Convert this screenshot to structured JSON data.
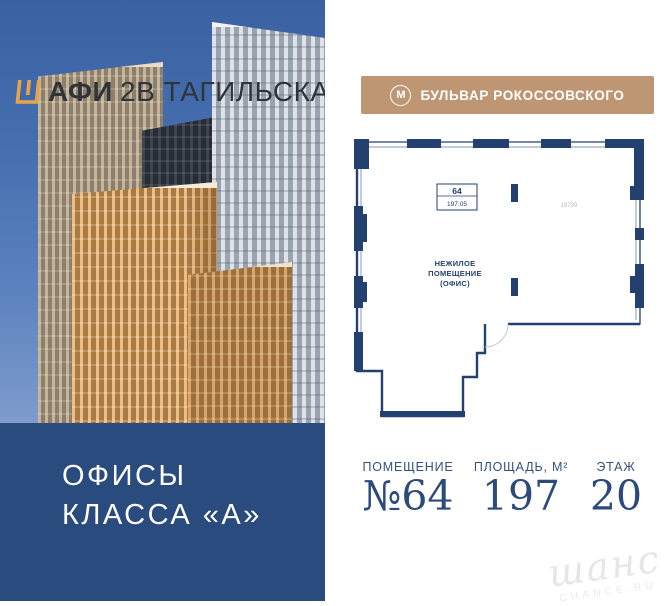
{
  "brand": {
    "logo_glyph": "afi-mark",
    "name_bold": "АФИ",
    "name_rest": "2В ТАГИЛЬСКАЯ"
  },
  "hero": {
    "offices_line1": "ОФИСЫ",
    "offices_line2": "КЛАССА «А»"
  },
  "metro": {
    "icon_letter": "М",
    "label": "БУЛЬВАР РОКОССОВСКОГО"
  },
  "plan": {
    "unit_box_number": "64",
    "unit_box_area": "197.05",
    "room_label_line1": "НЕЖИЛОЕ",
    "room_label_line2": "ПОМЕЩЕНИЕ",
    "room_label_line3": "(ОФИС)",
    "dimension_label": "19739"
  },
  "details": {
    "columns": [
      {
        "label": "ПОМЕЩЕНИЕ",
        "value": "№64"
      },
      {
        "label": "ПЛОЩАДЬ, М²",
        "value": "197"
      },
      {
        "label": "ЭТАЖ",
        "value": "20"
      }
    ]
  },
  "watermark": {
    "script": "шанс",
    "caption": "CHANCE.RU"
  },
  "colors": {
    "brand_orange": "#E8A44A",
    "navy_panel": "#2A4B7E",
    "plan_navy": "#24406E",
    "metro_tan": "#BE9674",
    "logo_text": "#2F343B",
    "detail_navy": "#2C4A7A",
    "watermark_gray": "#E6E6E6"
  }
}
